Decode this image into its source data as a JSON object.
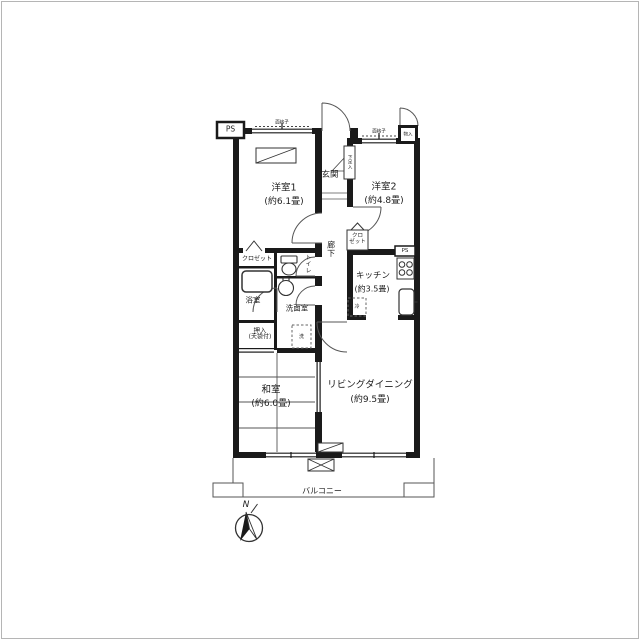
{
  "rooms": {
    "bedroom1": {
      "name": "洋室1",
      "size": "(約6.1畳)"
    },
    "bedroom2": {
      "name": "洋室2",
      "size": "(約4.8畳)"
    },
    "entrance": {
      "name": "玄関"
    },
    "shoe_box": {
      "name": "下足入"
    },
    "hallway": {
      "name": "廊下"
    },
    "closet_bedroom1": {
      "name": "クロゼット"
    },
    "closet_bedroom2": {
      "line1": "クロ",
      "line2": "ゼット"
    },
    "toilet": {
      "name": "トイレ"
    },
    "bathroom": {
      "name": "浴室"
    },
    "washroom": {
      "name": "洗面室"
    },
    "kitchen": {
      "name": "キッチン",
      "size": "(約3.5畳)"
    },
    "oshiire": {
      "name": "押入",
      "note": "(天袋付)"
    },
    "japanese_room": {
      "name": "和室",
      "size": "(約6.0畳)"
    },
    "living_dining": {
      "name": "リビングダイニング",
      "size": "(約9.5畳)"
    },
    "balcony": {
      "name": "バルコニー"
    }
  },
  "annotations": {
    "pipe_space_top": "PS",
    "pipe_space_kitchen": "PS",
    "storage_entrance": "物入",
    "window_grate_left": "面格子",
    "window_grate_right": "面格子",
    "washing_machine": "洗",
    "refrigerator": "冷",
    "compass_north": "N"
  },
  "colors": {
    "wall": "#1a1a1a",
    "line": "#555555",
    "background": "#ffffff",
    "border": "#b5b5b5"
  }
}
